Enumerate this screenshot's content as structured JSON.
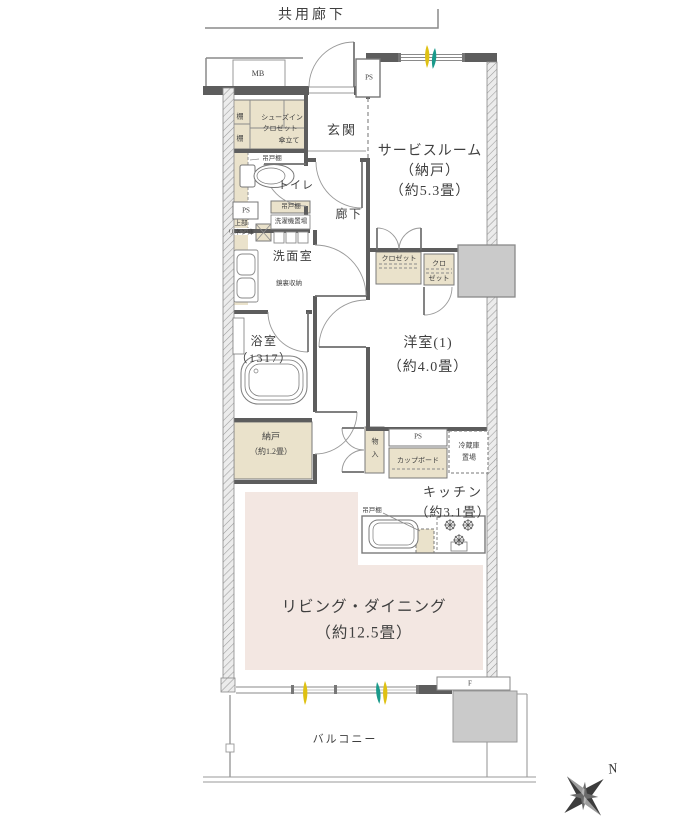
{
  "header": {
    "common_corridor": "共用廊下"
  },
  "rooms": {
    "entrance": "玄関",
    "hallway": "廊下",
    "toilet": "トイレ",
    "washroom": "洗面室",
    "bathroom_l1": "浴室",
    "bathroom_l2": "（1317）",
    "service_l1": "サービスルーム",
    "service_l2": "（納戸）",
    "service_l3": "（約5.3畳）",
    "western_l1": "洋室(1)",
    "western_l2": "（約4.0畳）",
    "nando_l1": "納戸",
    "nando_l2": "（約1.2畳）",
    "kitchen_l1": "キッチン",
    "kitchen_l2": "（約3.1畳）",
    "living_l1": "リビング・ダイニング",
    "living_l2": "（約12.5畳）",
    "balcony": "バルコニー"
  },
  "fixtures": {
    "mb": "MB",
    "ps": "PS",
    "shelf": "棚",
    "sic_l1": "シューズイン",
    "sic_l2": "クロゼット",
    "sic_l3": "傘立て",
    "hanging_cupboard": "吊戸棚",
    "washer_space": "洗濯機置場",
    "linen_l1": "上部",
    "linen_l2": "リネン庫",
    "mirror_storage": "鏡裏収納",
    "closet": "クロゼット",
    "closet2_l1": "クロ",
    "closet2_l2": "ゼット",
    "mono_l1": "物",
    "mono_l2": "入",
    "cupboard": "カップボード",
    "fridge_l1": "冷蔵庫",
    "fridge_l2": "置場",
    "fix_window": "F",
    "compass_north": "N"
  },
  "colors": {
    "closet_fill": "#eae2cb",
    "living_fill": "#f3e7e2",
    "pillar_fill": "#cacaca",
    "wall": "#5d5d5d",
    "accent_yellow": "#dfc113",
    "accent_teal": "#1a9a8b"
  }
}
